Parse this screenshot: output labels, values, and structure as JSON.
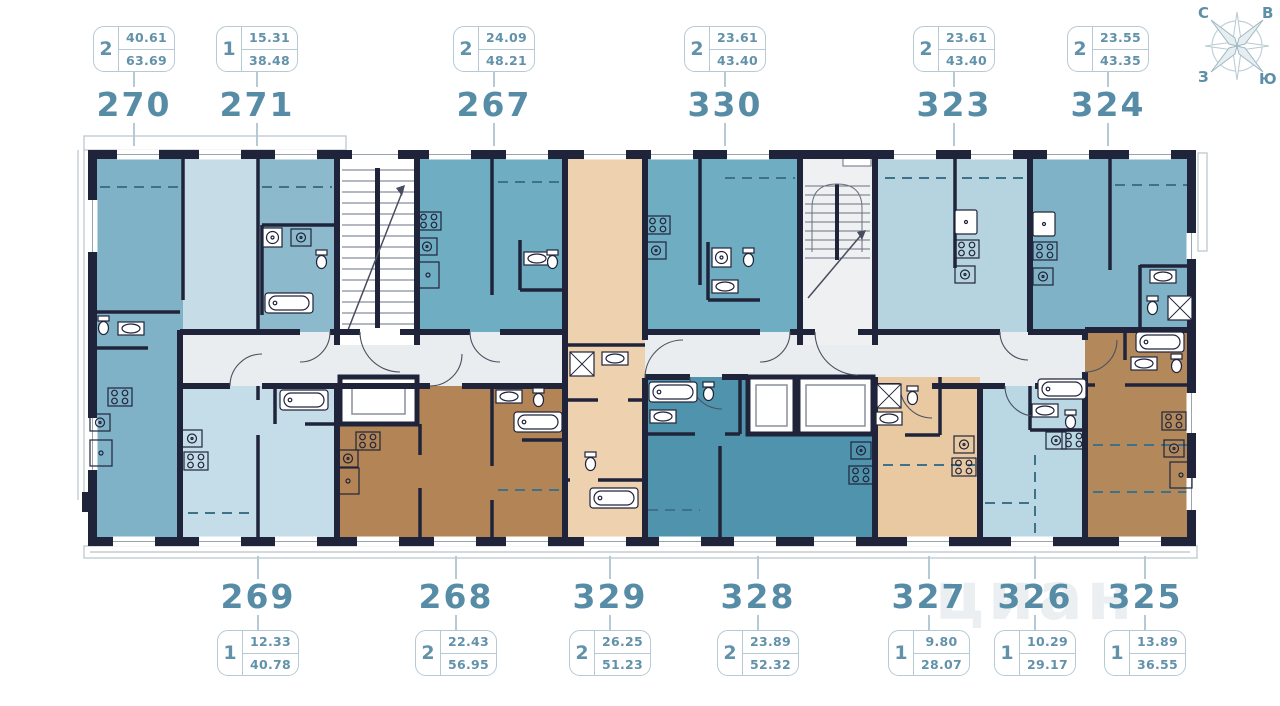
{
  "watermark": "циан",
  "compass": {
    "north": "С",
    "east": "В",
    "west": "З",
    "south": "Ю"
  },
  "top_apartments": [
    {
      "number": "270",
      "rooms": "2",
      "area_living": "40.61",
      "area_total": "63.69"
    },
    {
      "number": "271",
      "rooms": "1",
      "area_living": "15.31",
      "area_total": "38.48"
    },
    {
      "number": "267",
      "rooms": "2",
      "area_living": "24.09",
      "area_total": "48.21"
    },
    {
      "number": "330",
      "rooms": "2",
      "area_living": "23.61",
      "area_total": "43.40"
    },
    {
      "number": "323",
      "rooms": "2",
      "area_living": "23.61",
      "area_total": "43.40"
    },
    {
      "number": "324",
      "rooms": "2",
      "area_living": "23.55",
      "area_total": "43.35"
    }
  ],
  "bottom_apartments": [
    {
      "number": "269",
      "rooms": "1",
      "area_living": "12.33",
      "area_total": "40.78"
    },
    {
      "number": "268",
      "rooms": "2",
      "area_living": "22.43",
      "area_total": "56.95"
    },
    {
      "number": "329",
      "rooms": "2",
      "area_living": "26.25",
      "area_total": "51.23"
    },
    {
      "number": "328",
      "rooms": "2",
      "area_living": "23.89",
      "area_total": "52.32"
    },
    {
      "number": "327",
      "rooms": "1",
      "area_living": "9.80",
      "area_total": "28.07"
    },
    {
      "number": "326",
      "rooms": "1",
      "area_living": "10.29",
      "area_total": "29.17"
    },
    {
      "number": "325",
      "rooms": "1",
      "area_living": "13.89",
      "area_total": "36.55"
    }
  ],
  "colors": {
    "wall": "#20243a",
    "accent_text": "#578ca6",
    "badge_border": "#b5cad4",
    "dashed": "#3f7189",
    "corridor": "#e9edf0",
    "stairwell": "#eef0f2",
    "apt270": "#7fb2c6",
    "apt271": "#c6dde8",
    "apt270_room2": "#8cbacc",
    "apt267": "#6fadc2",
    "apt330": "#6fadc2",
    "apt323": "#b6d4e0",
    "apt324": "#7fb2c6",
    "apt269": "#c4dde8",
    "apt268": "#b28456",
    "apt329": "#eed1af",
    "apt328": "#4f93ad",
    "apt327": "#e9c9a2",
    "apt326": "#bad8e3",
    "apt325": "#b3895c"
  }
}
